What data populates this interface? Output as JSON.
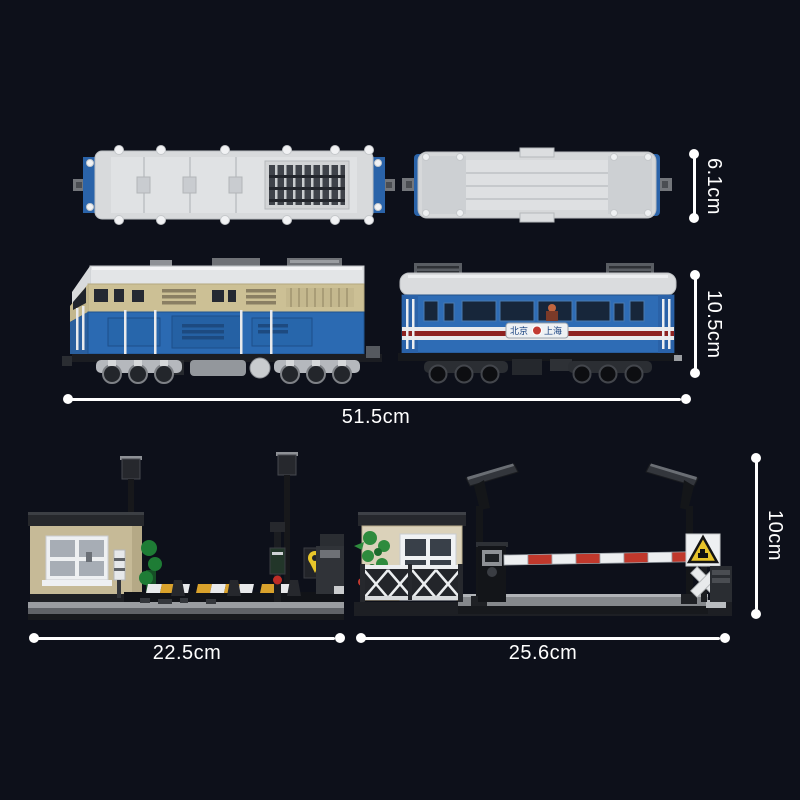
{
  "scene": {
    "background_color": "#0d101a",
    "annotation_color": "#ffffff",
    "description": "brick-built train set with two roof views, locomotive and coach side views, and two level-crossing dioramas"
  },
  "dimensions": {
    "roof_width": "6.1cm",
    "train_height": "10.5cm",
    "train_length": "51.5cm",
    "left_scene_length": "22.5cm",
    "right_scene_length": "25.6cm",
    "scene_height": "10cm"
  },
  "coach": {
    "sign_left": "北京",
    "sign_right": "上海"
  },
  "colors": {
    "locomotive_blue": "#2b6ab2",
    "locomotive_cream": "#ccc095",
    "coach_blue": "#2e6cb5",
    "stripe_red": "#8e2322",
    "barrier_red": "#c0382c",
    "warning_sign_yellow": "#e7c32a",
    "hut_tan": "#c6ba97"
  }
}
